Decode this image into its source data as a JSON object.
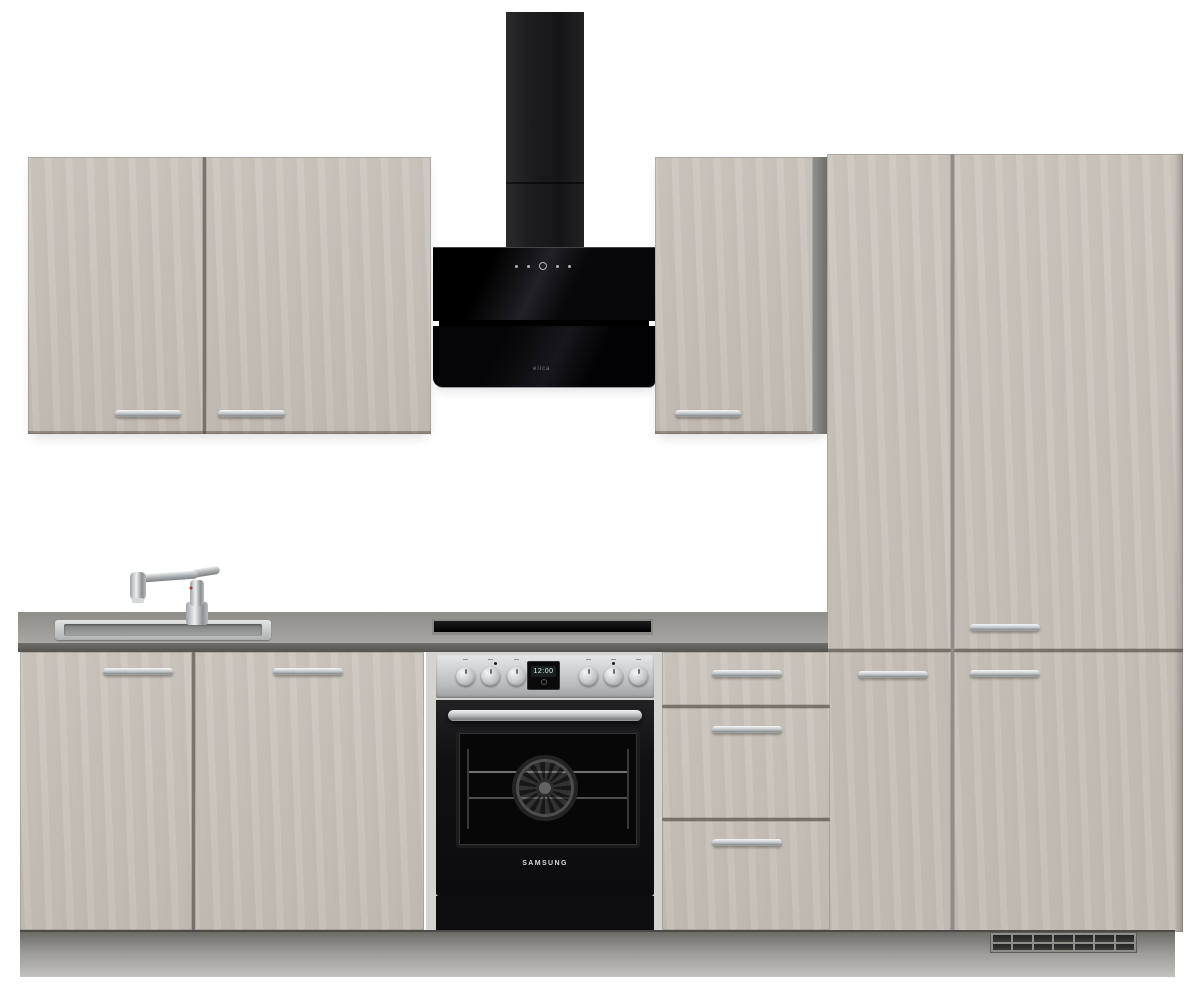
{
  "scene": {
    "background_color": "#ffffff",
    "colors": {
      "cabinet_front": "#c7c0b8",
      "cabinet_carcass": "#7d7a74",
      "countertop_top": "#9b9a95",
      "countertop_edge": "#64625e",
      "plinth": "#9b9a94",
      "handle_silver": "#c9cbcc",
      "hood_black": "#0c0c0e",
      "oven_stainless": "#c6c9cb",
      "appliance_black": "#141414"
    }
  },
  "hood": {
    "brand_mark": "elica",
    "control_icons": [
      "minus-icon",
      "fan-speed-icon",
      "power-icon",
      "light-icon",
      "timer-icon"
    ]
  },
  "oven": {
    "brand": "SAMSUNG",
    "display_time": "12:00",
    "knob_count": 6
  },
  "cabinets": {
    "wall_left": {
      "doors": 2,
      "handles": 2
    },
    "wall_right": {
      "doors": 1,
      "handles": 1
    },
    "tall_left": {
      "doors": 2,
      "handles": 1
    },
    "tall_right": {
      "doors": 2,
      "handles": 2
    },
    "base_left": {
      "doors": 2,
      "handles": 2
    },
    "drawer_unit": {
      "drawers": 3,
      "handles": 3
    },
    "vent_grille_slots": 14
  }
}
